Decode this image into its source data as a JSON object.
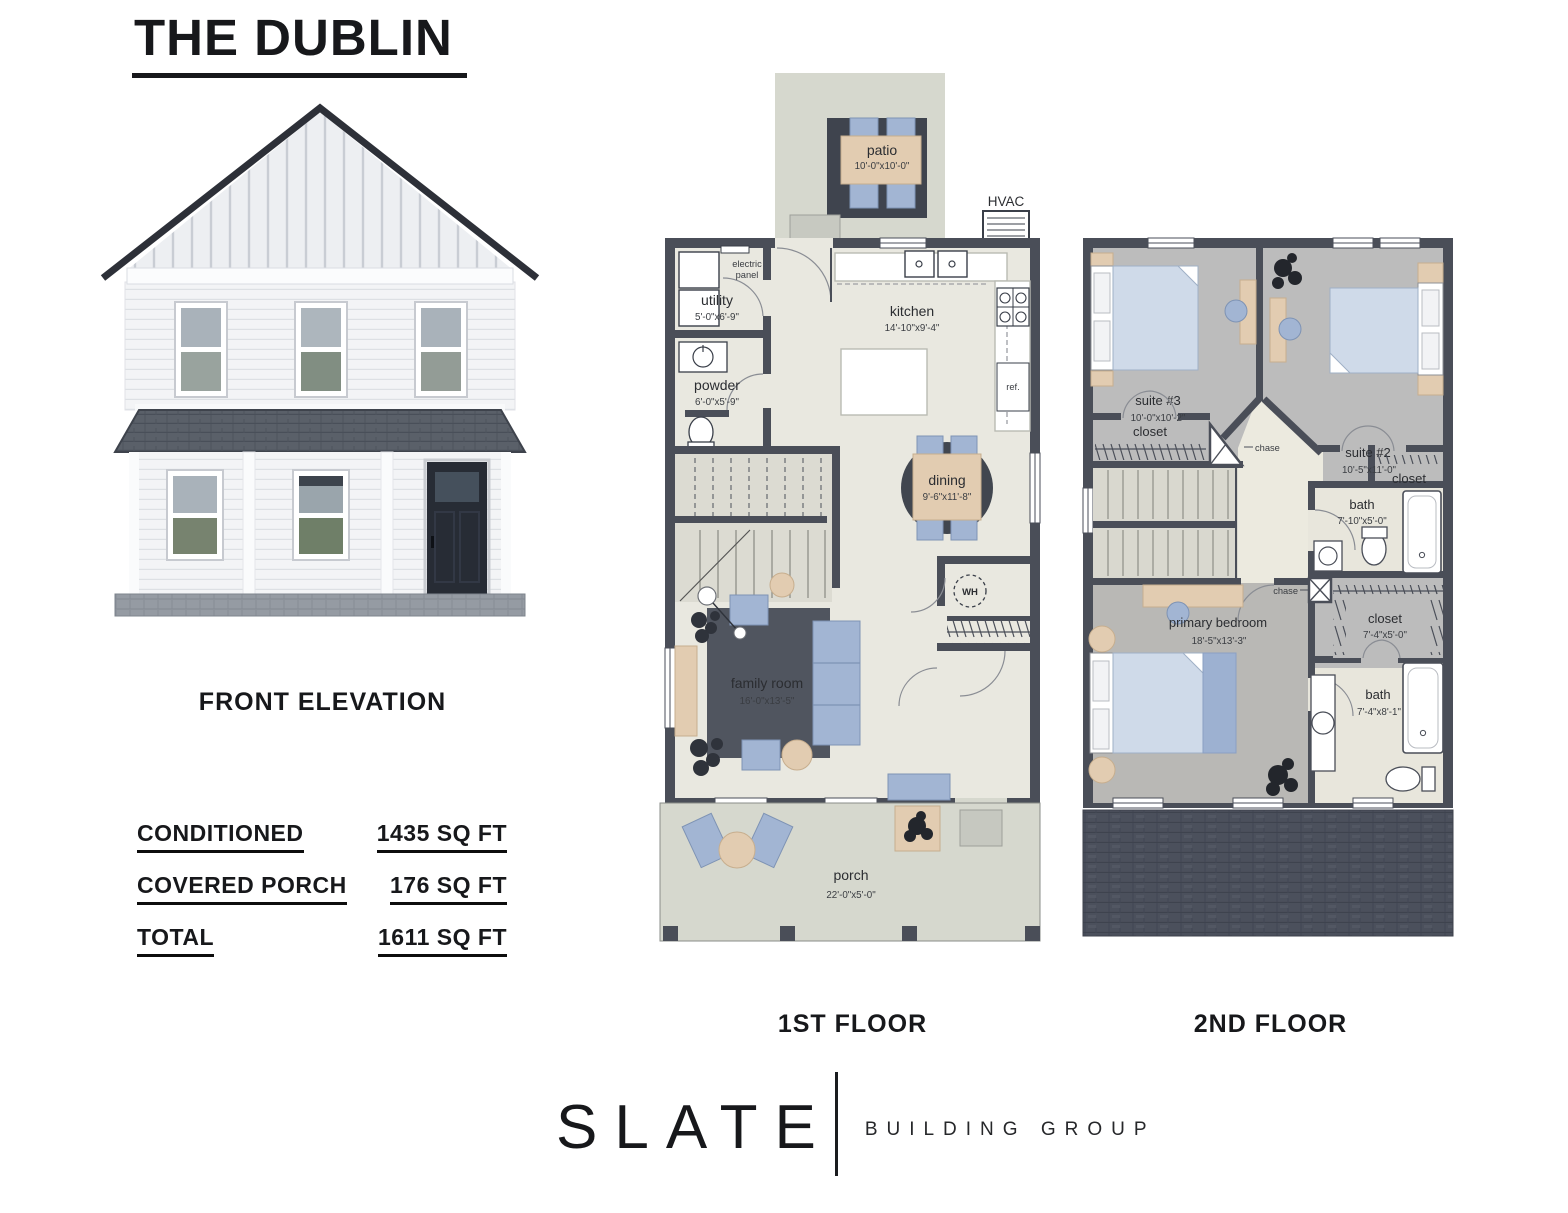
{
  "title": "THE DUBLIN",
  "elevation_caption": "FRONT ELEVATION",
  "specs": {
    "rows": [
      {
        "label": "CONDITIONED",
        "value": "1435 SQ FT"
      },
      {
        "label": "COVERED PORCH",
        "value": "176 SQ FT"
      },
      {
        "label": "TOTAL",
        "value": "1611 SQ FT"
      }
    ]
  },
  "floor1": {
    "caption": "1ST FLOOR",
    "patio": {
      "label": "patio",
      "dims": "10'-0\"x10'-0\""
    },
    "hvac_label": "HVAC",
    "electric_panel": {
      "line1": "electric",
      "line2": "panel"
    },
    "utility": {
      "label": "utility",
      "dims": "5'-0\"x6'-9\""
    },
    "powder": {
      "label": "powder",
      "dims": "6'-0\"x5'-9\""
    },
    "kitchen": {
      "label": "kitchen",
      "dims": "14'-10\"x9'-4\""
    },
    "ref_label": "ref.",
    "dining": {
      "label": "dining",
      "dims": "9'-6\"x11'-8\""
    },
    "wh_label": "WH",
    "family_room": {
      "label": "family room",
      "dims": "16'-0\"x13'-5\""
    },
    "porch": {
      "label": "porch",
      "dims": "22'-0\"x5'-0\""
    }
  },
  "floor2": {
    "caption": "2ND FLOOR",
    "suite3": {
      "label": "suite #3",
      "dims": "10'-0\"x10'-2\""
    },
    "suite2": {
      "label": "suite #2",
      "dims": "10'-5\"x11'-0\""
    },
    "closet_suite3": {
      "label": "closet"
    },
    "chase_upper": {
      "label": "chase"
    },
    "closet_suite2": {
      "label": "closet"
    },
    "bath_upper": {
      "label": "bath",
      "dims": "7'-10\"x5'-0\""
    },
    "chase_lower": {
      "label": "chase"
    },
    "closet_primary": {
      "label": "closet",
      "dims": "7'-4\"x5'-0\""
    },
    "primary_bedroom": {
      "label": "primary bedroom",
      "dims": "18'-5\"x13'-3\""
    },
    "bath_primary": {
      "label": "bath",
      "dims": "7'-4\"x8'-1\""
    }
  },
  "logo": {
    "name": "SLATE",
    "tagline": "BUILDING GROUP"
  },
  "colors": {
    "wall": "#4a4e58",
    "floor_light": "#e9e8e0",
    "outdoor": "#d6d8ce",
    "bedroom_floor": "#bcbcbc",
    "furniture_blue": "#a2b5d3",
    "furniture_tan": "#e2ccb1",
    "rug_dark": "#50555f",
    "shingle": "#4b505c",
    "ink": "#17181b"
  }
}
